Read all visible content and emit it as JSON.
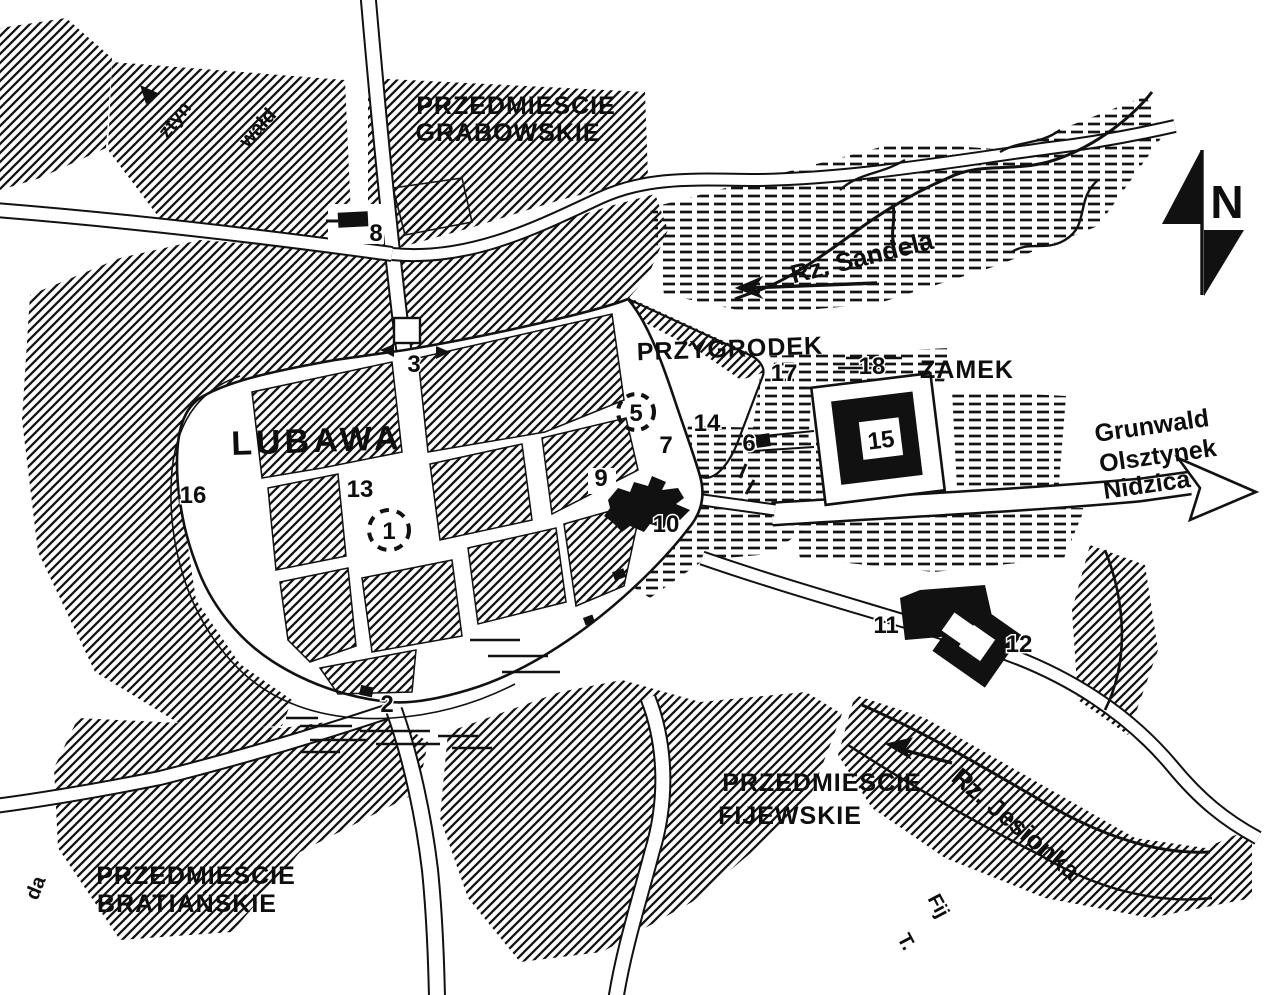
{
  "labels": {
    "town": "LUBAWA",
    "przygrodek": "PRZYGRODEK",
    "zamek": "ZAMEK",
    "suburb_grabowskie": [
      "PRZEDMIEŚCIE",
      "GRABOWSKIE"
    ],
    "suburb_fijewskie": [
      "PRZEDMIEŚCIE",
      "FIJEWSKIE"
    ],
    "suburb_bratianskie": [
      "PRZEDMIEŚCIE",
      "BRATIAŃSKIE"
    ]
  },
  "rivers": {
    "sandela": "Rz. Sandela",
    "jesionka": "Rz. Jesionka"
  },
  "road_destinations": [
    "Grunwald",
    "Olsztynek",
    "Nidzica"
  ],
  "edge_labels": {
    "top_left_partial_1": "ztyn",
    "top_left_partial_2": "wałd",
    "bottom_left_partial": "da",
    "bottom_right_partial_1": "Fij",
    "bottom_right_partial_2": "T."
  },
  "compass_north": "N",
  "markers": {
    "m1": "1",
    "m2": "2",
    "m3": "3",
    "m5": "5",
    "m6": "6",
    "m7": "7",
    "m8": "8",
    "m9": "9",
    "m10": "10",
    "m11": "11",
    "m12": "12",
    "m13": "13",
    "m14": "14",
    "m15": "15",
    "m16": "16",
    "m17": "17",
    "m18": "18"
  }
}
